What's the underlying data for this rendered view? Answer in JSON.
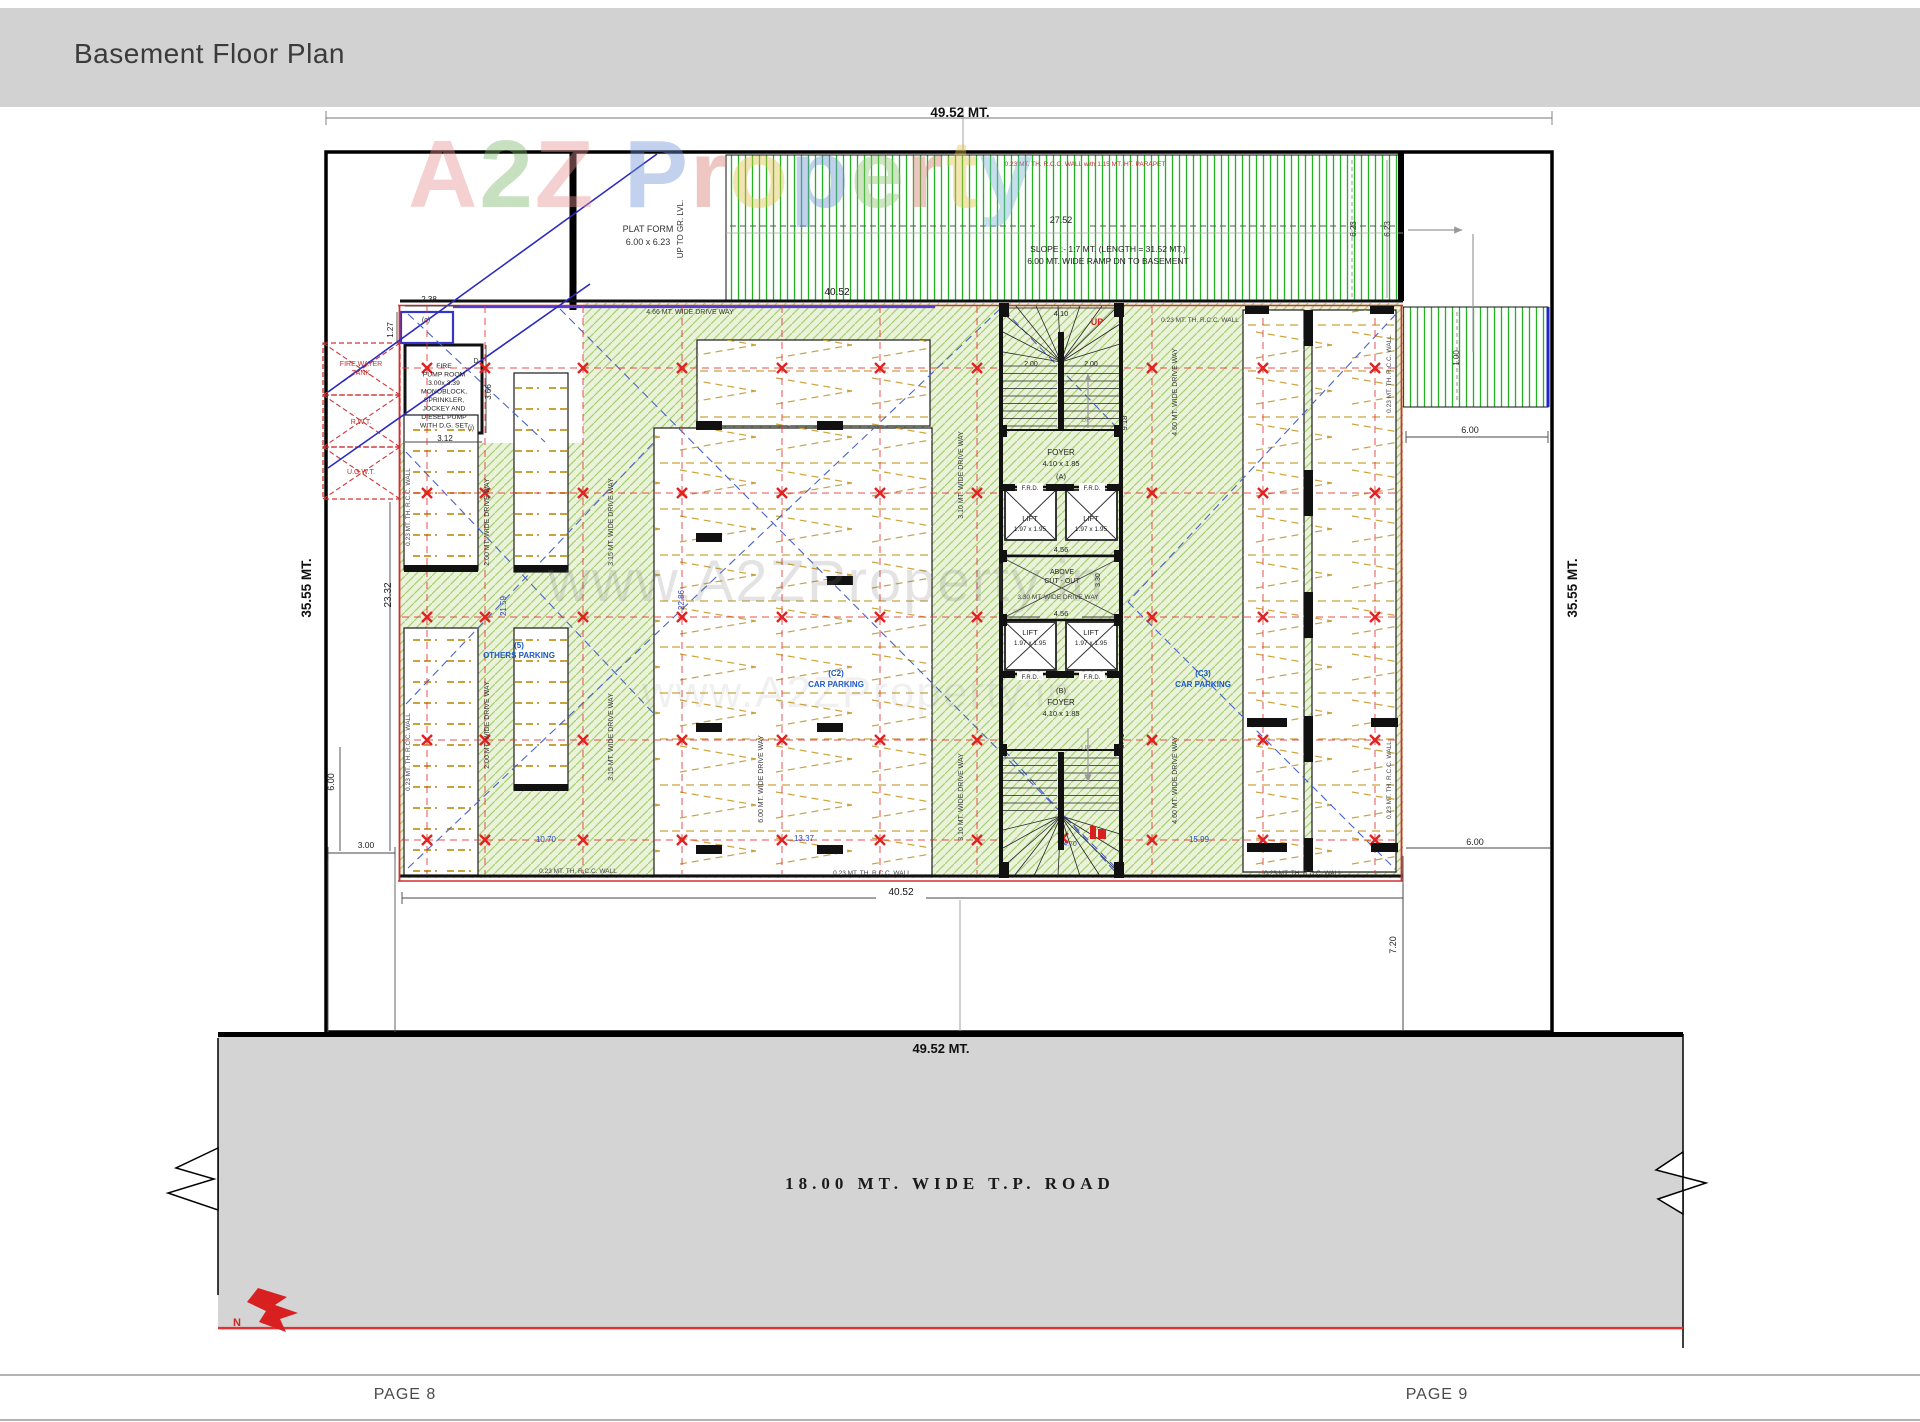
{
  "header": {
    "title": "Basement Floor Plan"
  },
  "footer": {
    "page_left": "PAGE 8",
    "page_right": "PAGE 9"
  },
  "road": {
    "label": "18.00  MT.  WIDE  T.P.  ROAD"
  },
  "compass": {
    "north": "N"
  },
  "watermark": {
    "a": "A",
    "two": "2",
    "z": "Z",
    "rest": "Property",
    "url": "www.A2ZProperty.in"
  },
  "dims": {
    "d4952": "49.52 MT.",
    "d3555": "35.55 MT.",
    "d4052": "40.52",
    "d2752": "27.52",
    "d2332": "23.32",
    "d2159": "21.59",
    "d2286": "22.86",
    "d1070": "10.70",
    "d1337": "13.37",
    "d1599": "15.99",
    "d623": "6.23",
    "d600": "6.00",
    "d720": "7.20",
    "d300": "3.00",
    "d100": "1.00",
    "d238": "2.38",
    "d127": "1.27",
    "d312": "3.12",
    "d366": "3.66",
    "d410": "4.10",
    "d456": "4.56",
    "d200": "2.00",
    "d330": "3.30",
    "d918": "9.18",
    "d941": "9.41",
    "d470": "4.70"
  },
  "ramp": {
    "parapet": "0.23 MT. TH. R.C.C. WALL with 1.15 MT. HT. PARAPET",
    "slope_line1": "SLOPE :- 1:7 MT. (LENGTH = 31.52 MT.)",
    "slope_line2": "6.00 MT. WIDE  RAMP DN TO BASEMENT",
    "up_to_gr": "UP TO GR. LVL."
  },
  "platform": {
    "line1": "PLAT FORM",
    "line2": "6.00 x 6.23"
  },
  "tanks": {
    "fire_line1": "FIRE WATER",
    "fire_line2": "TANK",
    "rwt": "R.W.T.",
    "ugwt": "U.G.W.T."
  },
  "pump_room": {
    "l1": "FIRE",
    "l2": "PUMP ROOM",
    "l3": "3.00x 3.39",
    "l4": "MONOBLOCK,",
    "l5": "SPRINKLER,",
    "l6": "JOCKEY AND",
    "l7": "DIESEL PUMP",
    "l8": "WITH D.G. SET",
    "tag_c": "(c)",
    "tag_d": "D",
    "tag_i": "(i)"
  },
  "labels": {
    "wall": "0.23 MT. TH. R.C.C. WALL",
    "dw200": "2.00 MT. WIDE DRIVE WAY",
    "dw315": "3.15 MT. WIDE DRIVE WAY",
    "dw310": "3.10 MT. WIDE DRIVE WAY",
    "dw460": "4.60 MT. WIDE DRIVE WAY",
    "dw466": "4.66 MT. WIDE DRIVE WAY",
    "dw600": "6.00 MT. WIDE DRIVE WAY",
    "dw330": "3.30 MT. WIDE DRIVE WAY",
    "above_cutout_1": "ABOVE",
    "above_cutout_2": "CUT - OUT",
    "up": "UP",
    "foyer": "FOYER",
    "foyer_size": "4.10 x 1.85",
    "tag_a": "(A)",
    "tag_b": "(B)",
    "lift": "LIFT",
    "lift_size": "1.97 x 1.95",
    "frd": "F.R.D.",
    "others_tag": "(5)",
    "others": "OTHERS PARKING",
    "c2_tag": "(C2)",
    "c3_tag": "(C3)",
    "car_parking": "CAR PARKING"
  },
  "colors": {
    "hatch_green": "#a6cf73",
    "ramp_green": "#25b325",
    "grid_red": "#e23333",
    "parking_tan": "#c9a23b",
    "label_blue": "#1b57c9",
    "road_gray": "#d4d4d4",
    "accent_red": "#d92020",
    "header_gray": "#d2d2d2"
  }
}
